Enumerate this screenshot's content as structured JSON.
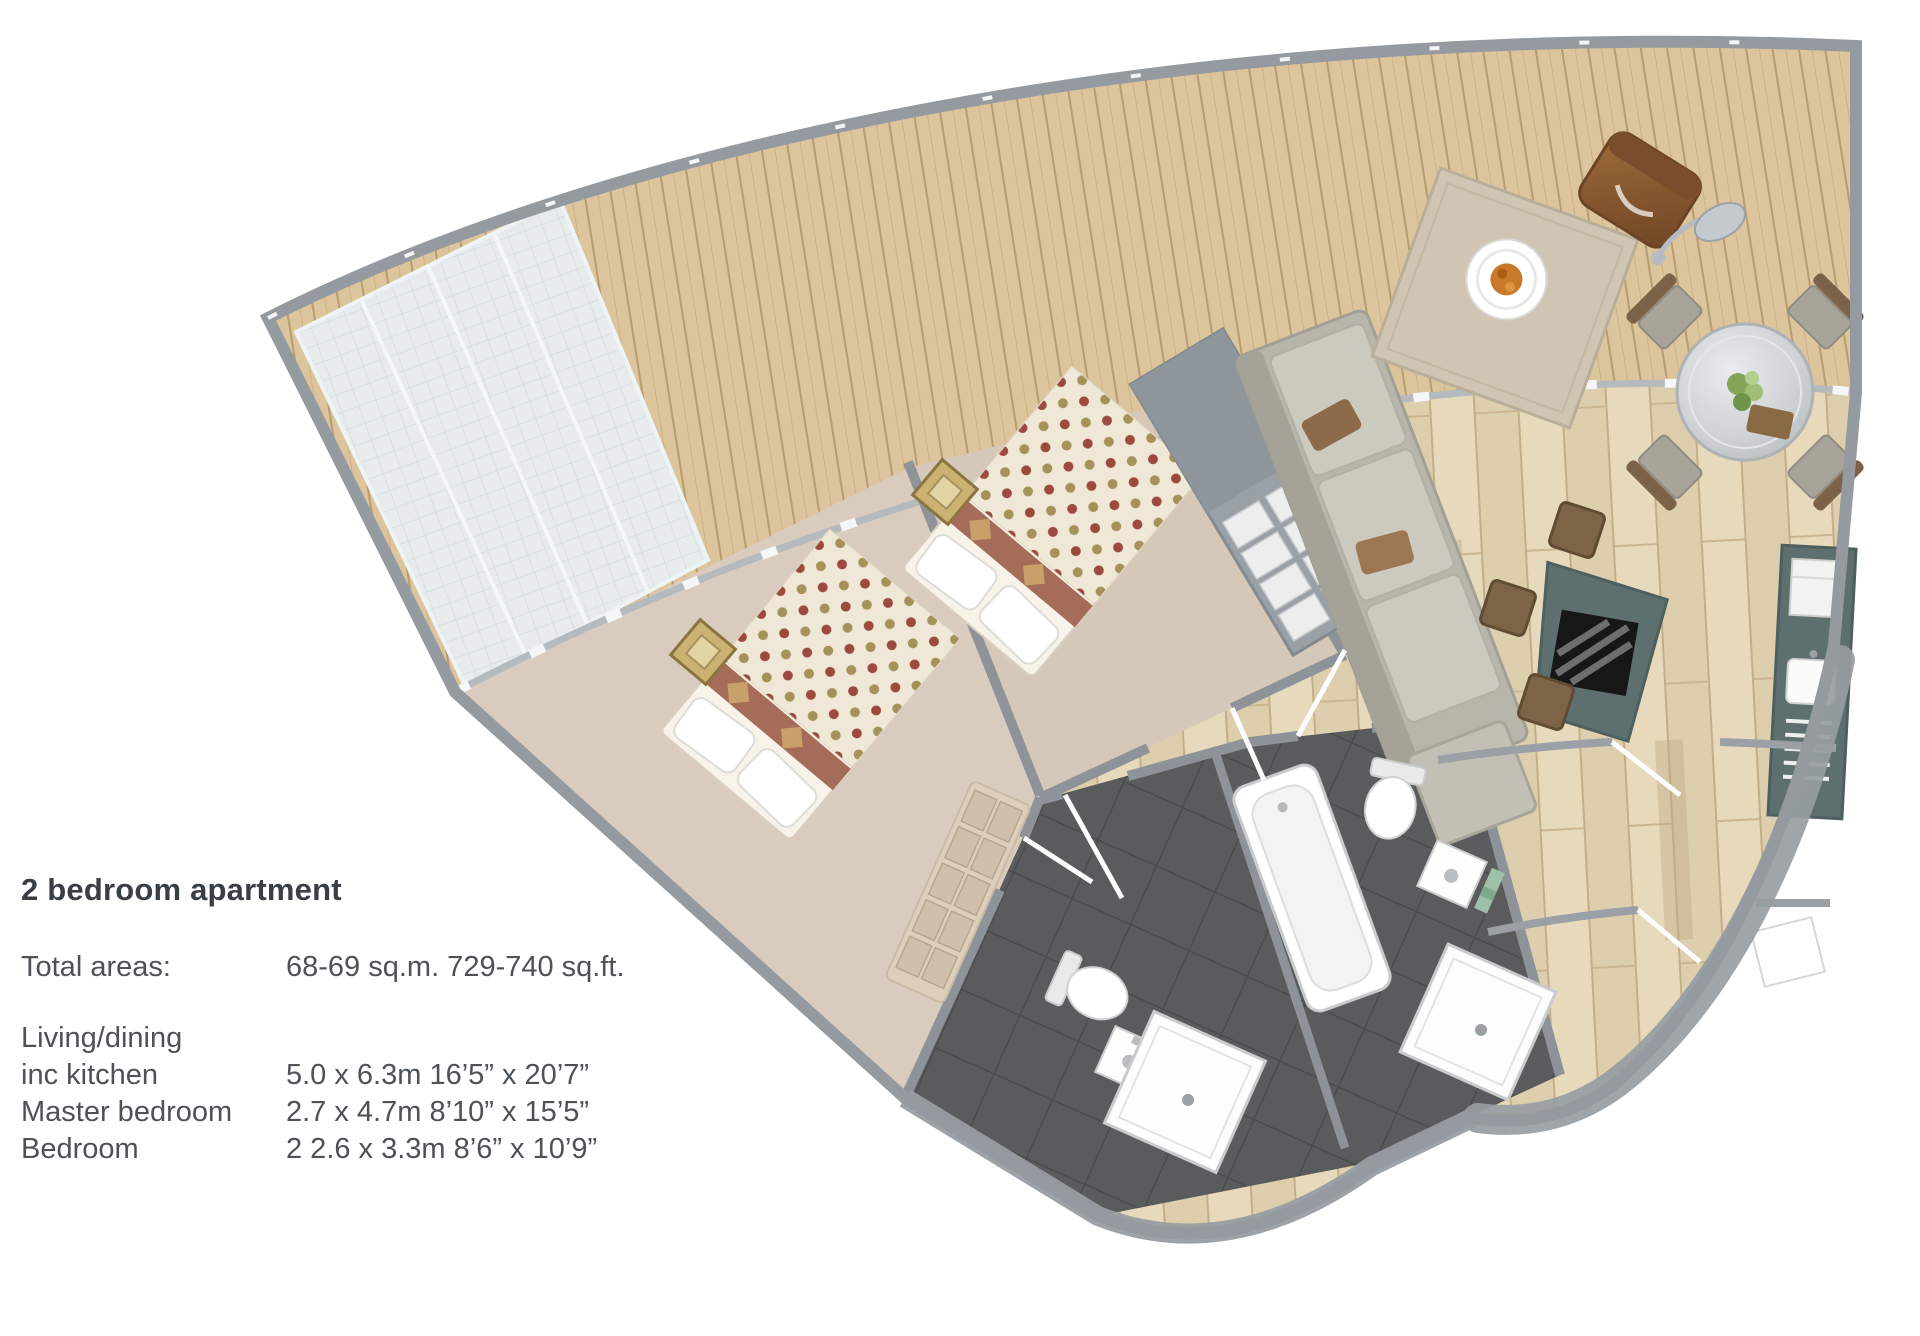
{
  "title": "2 bedroom apartment",
  "specs": {
    "total": {
      "label": "Total areas:",
      "value": "68-69 sq.m. 729-740 sq.ft."
    },
    "rows": [
      {
        "label": "Living/dining",
        "value": ""
      },
      {
        "label": "inc kitchen",
        "value": "5.0 x 6.3m 16’5” x 20’7”"
      },
      {
        "label": "Master bedroom",
        "value": "2.7 x 4.7m 8’10” x 15’5”"
      },
      {
        "label": "Bedroom",
        "value": "2 2.6 x 3.3m 8’6” x 10’9”"
      }
    ]
  },
  "floorplan": {
    "type": "fan-shaped 2 bedroom apartment floor plan, top-down 3D render",
    "areas": [
      "terrace deck",
      "bedroom",
      "master bedroom",
      "living/dining inc kitchen",
      "bathroom",
      "ensuite bathroom",
      "entrance hall"
    ],
    "furniture": [
      "double bed x2 with polka-dot covers",
      "bedside table x2",
      "storage bench",
      "wardrobe with shelves",
      "sofa with ottoman",
      "coffee table with plate of food",
      "leather armchair",
      "arc floor lamp",
      "round dining table with 4 chairs",
      "kitchen island with hob",
      "bar stools",
      "kitchen counter with sink and drainer",
      "bathtub",
      "shower tray x2",
      "toilet x2",
      "washbasin x2"
    ],
    "colors": {
      "deck_wood": "#d9c097",
      "floor_wood": "#e4d6ba",
      "carpet": "#d9ccbe",
      "wall_gray": "#8d9398",
      "glass_panel": "#e8edef",
      "bathroom_tile": "#595b5c",
      "kitchen_teal": "#5d706f",
      "bed_dot_red": "#9c4a40",
      "bed_dot_olive": "#a4925a",
      "food_orange": "#c87a2a",
      "text": "#4d5257"
    }
  }
}
